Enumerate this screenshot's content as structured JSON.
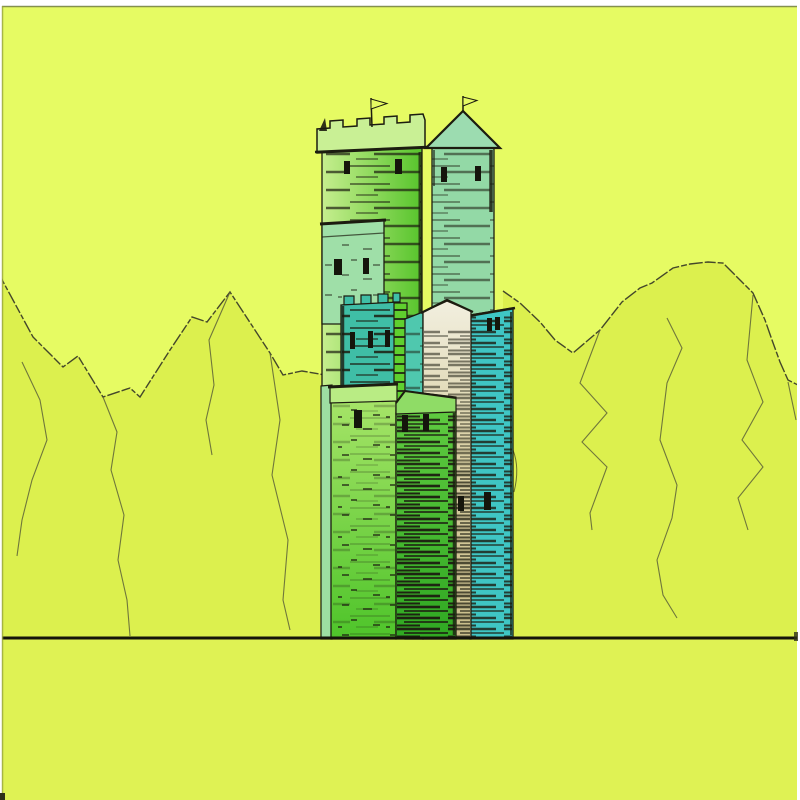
{
  "image": {
    "alt": "Sketch-style clipart of a cluster of tall medieval towers in greens, teal, cyan and tan, with pennant flags, standing before jagged yellow-green hills under a chartreuse sky above a flat ground line",
    "style": "pen-and-ink outlines with flat digital colour and horizontal hatching",
    "elements": [
      "sky",
      "left-hills",
      "right-hills",
      "ground",
      "crenellated-tower",
      "spired-tower",
      "mid-tower",
      "teal-crenellated-tower",
      "ladder-strip",
      "tan-gabled-tower",
      "cyan-tower",
      "front-left-tower",
      "front-mid-tower",
      "pennant-flags",
      "windows"
    ]
  },
  "colors": {
    "frame_bg": "#ffffff",
    "sky": "#e6fb63",
    "hills": "#dcf04e",
    "ground": "#dff254",
    "ink": "#1c1c10",
    "ridge": "#44472a",
    "crack": "#5d6238",
    "ground_line": "#14140a",
    "edge_line": "#97a53d",
    "top_line": "#6b7747",
    "back_left_light": "#c6ee8e",
    "back_left_dark": "#57c42c",
    "parapet": "#c9f095",
    "flag": "#e6fb63",
    "mint": "#93d9a6",
    "mint_roof": "#9cdcb0",
    "sage": "#9fdfa8",
    "teal": "#3fbea6",
    "ladder": "#5fd02e",
    "tan_side": "#4fc8ae",
    "tan_top": "#f2efdf",
    "tan_mid": "#d8cfa2",
    "tan_bottom": "#c9bd8a",
    "cyan": "#3fc6c4",
    "front_left_top": "#a6e468",
    "front_left_bottom": "#4ec42a",
    "front_left_side": "#9ddfa2",
    "band_light": "#b9ec84",
    "front_mid_top": "#5fca40",
    "front_mid_bottom": "#2fa822",
    "band_mid": "#8fdc66",
    "window": "#15150c",
    "corner_mark": "#2e3018"
  }
}
